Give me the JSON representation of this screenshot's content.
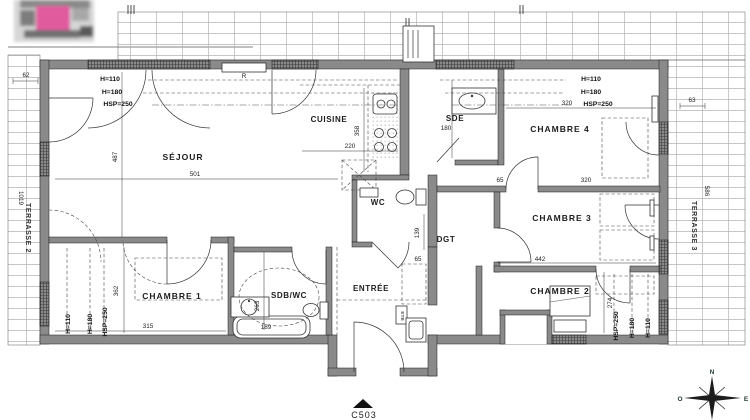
{
  "colors": {
    "wall": "#8a8a8a",
    "line": "#1c1c1c",
    "tile": "#adadad",
    "logo_pink": "#e05a9e"
  },
  "heights": {
    "h110": "H=110",
    "h180": "H=180",
    "hsp250": "HSP=250"
  },
  "rooms": {
    "sejour": {
      "label": "SÉJOUR",
      "dim_w": "501",
      "dim_h": "487"
    },
    "cuisine": {
      "label": "CUISINE",
      "dim_w": "220",
      "dim_h": "358"
    },
    "wc": {
      "label": "WC"
    },
    "sde": {
      "label": "SDE",
      "dim": "180"
    },
    "chambre4": {
      "label": "CHAMBRE 4",
      "dim_w": "320"
    },
    "chambre3": {
      "label": "CHAMBRE 3",
      "dim_w": "320",
      "dim_offset": "65",
      "dim_bottom": "442"
    },
    "chambre2": {
      "label": "CHAMBRE 2",
      "dim_h": "274"
    },
    "chambre1": {
      "label": "CHAMBRE 1",
      "dim_w": "315",
      "dim_h": "362"
    },
    "sdbwc": {
      "label": "SDB/WC",
      "dim_tub": "189",
      "dim_h": "263"
    },
    "entree": {
      "label": "ENTRÉE",
      "closet_dim": "65"
    },
    "dgt": {
      "label": "DGT",
      "dim_h": "139"
    }
  },
  "terraces": {
    "t2": {
      "label": "TERRASSE 2",
      "dim_l": "1019",
      "dim_w": "62"
    },
    "t3": {
      "label": "TERRASSE 3",
      "dim_l": "586",
      "dim_w": "63"
    }
  },
  "fixtures": {
    "radiator": "R",
    "panel": "ETB"
  },
  "unit": {
    "label": "C503"
  },
  "compass": {
    "n": "N",
    "s": "S",
    "e": "E",
    "o": "O"
  }
}
